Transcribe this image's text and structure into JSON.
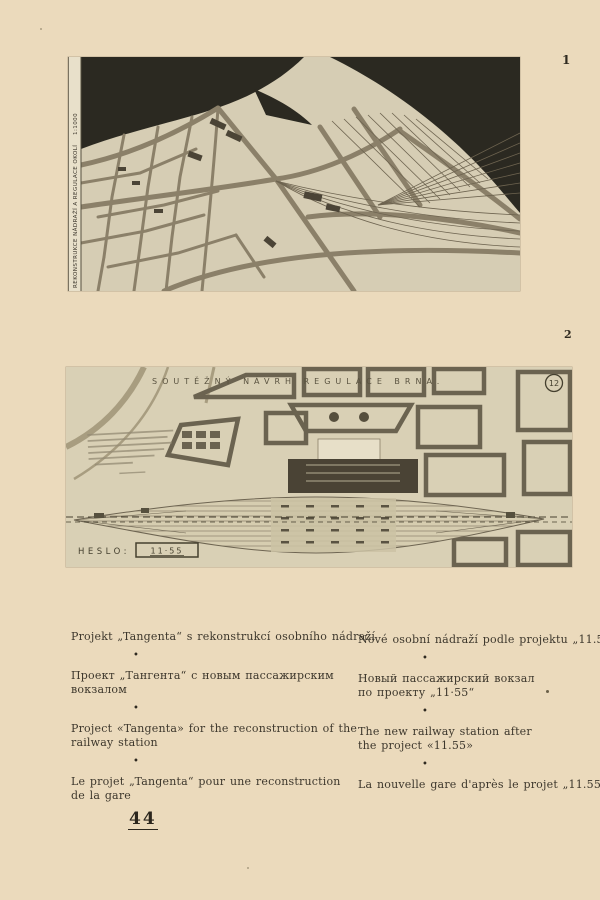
{
  "page": {
    "number": "44"
  },
  "figure1": {
    "number": "1",
    "side_label": "REKONSTRUKCE NÁDRAŽÍ A REGULACE OKOLÍ",
    "scale_label": "1:1000"
  },
  "figure2": {
    "number": "2",
    "title": "SOUTĚŽNÝ NÁVRH REGULACE BRNA.",
    "badge": "12",
    "motto_label": "HESLO:",
    "motto_value": "11·55"
  },
  "captions": {
    "separator": "•",
    "left": [
      {
        "lang": "cs",
        "lines": [
          "Projekt „Tangenta“ s rekonstrukcí osobního nádraží"
        ]
      },
      {
        "lang": "ru",
        "lines": [
          "Проект „Тангента“ с новым пассажирским",
          "вокзалом"
        ]
      },
      {
        "lang": "en",
        "lines": [
          "Project «Tangenta» for the reconstruction of the",
          "railway station"
        ]
      },
      {
        "lang": "fr",
        "lines": [
          "Le projet „Tangenta“ pour une reconstruction",
          "de la gare"
        ]
      }
    ],
    "right": [
      {
        "lang": "cs",
        "lines": [
          "Nové osobní nádraží podle projektu „11.55“"
        ]
      },
      {
        "lang": "ru",
        "lines": [
          "Новый пассажирский вокзал",
          "по проекту „11·55“"
        ]
      },
      {
        "lang": "en",
        "lines": [
          "The new railway station after",
          "the project «11.55»"
        ]
      },
      {
        "lang": "fr",
        "lines": [
          "La nouvelle gare d'après le projet „11.55“"
        ]
      }
    ]
  }
}
